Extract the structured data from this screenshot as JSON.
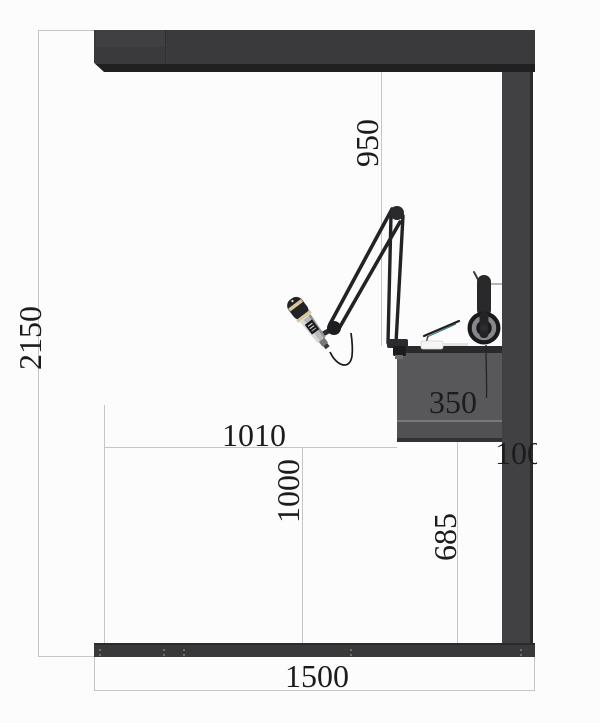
{
  "title": "Booth side elevation technical drawing",
  "dims": {
    "total_height": "2150",
    "boom_drop": "950",
    "desk_span": "1010",
    "mid_height": "1000",
    "under_desk": "685",
    "desk_depth": "350",
    "column_width": "100",
    "total_width": "1500"
  },
  "objects": {
    "microphone": "dynamic-microphone-on-boom",
    "boom_arm": "scissor-boom-arm",
    "headphones": "headphones-on-hook",
    "laptop": "laptop-on-riser",
    "desk": "wall-mounted-desk",
    "frame": "booth-frame"
  },
  "colors": {
    "frame_dark": "#3a3a3c",
    "column": "#414143",
    "desk": "#58585a",
    "dimension_line": "#c6c6c6",
    "text": "#1c1c1c",
    "mic_band": "#d7c79c",
    "laptop_accent": "#2f7a7a"
  }
}
